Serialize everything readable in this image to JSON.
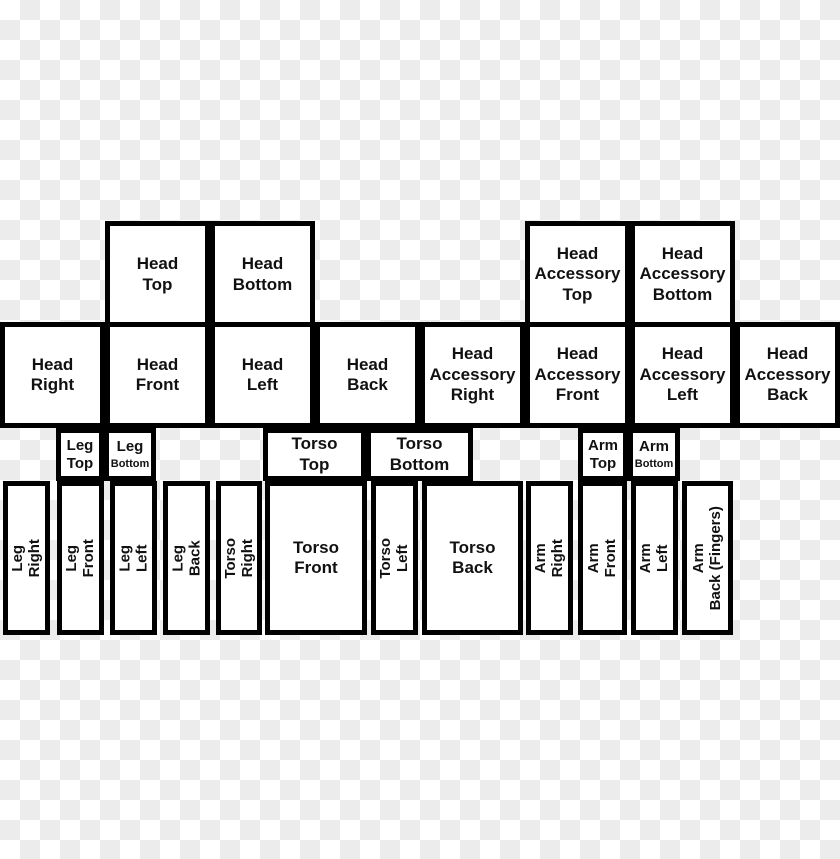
{
  "image": {
    "width": 840,
    "height": 859
  },
  "colors": {
    "checker_light": "#ffffff",
    "checker_dark": "#ececec",
    "box_fill": "#ffffff",
    "box_border": "#000000",
    "text": "#111111"
  },
  "cells": {
    "head_top": {
      "label": "Head\nTop"
    },
    "head_bottom": {
      "label": "Head\nBottom"
    },
    "head_accessory_top": {
      "label": "Head\nAccessory\nTop"
    },
    "head_accessory_bottom": {
      "label": "Head\nAccessory\nBottom"
    },
    "head_right": {
      "label": "Head\nRight"
    },
    "head_front": {
      "label": "Head\nFront"
    },
    "head_left": {
      "label": "Head\nLeft"
    },
    "head_back": {
      "label": "Head\nBack"
    },
    "head_accessory_right": {
      "label": "Head\nAccessory\nRight"
    },
    "head_accessory_front": {
      "label": "Head\nAccessory\nFront"
    },
    "head_accessory_left": {
      "label": "Head\nAccessory\nLeft"
    },
    "head_accessory_back": {
      "label": "Head\nAccessory\nBack"
    },
    "leg_top": {
      "label": "Leg\nTop"
    },
    "leg_bottom": {
      "label": "Leg\nBottom"
    },
    "torso_top": {
      "label": "Torso\nTop"
    },
    "torso_bottom": {
      "label": "Torso\nBottom"
    },
    "arm_top": {
      "label": "Arm\nTop"
    },
    "arm_bottom": {
      "label": "Arm\nBottom"
    },
    "leg_right": {
      "label": "Leg\nRight"
    },
    "leg_front": {
      "label": "Leg\nFront"
    },
    "leg_left": {
      "label": "Leg\nLeft"
    },
    "leg_back": {
      "label": "Leg\nBack"
    },
    "torso_right": {
      "label": "Torso\nRight"
    },
    "torso_front": {
      "label": "Torso\nFront"
    },
    "torso_left": {
      "label": "Torso\nLeft"
    },
    "torso_back": {
      "label": "Torso\nBack"
    },
    "arm_right": {
      "label": "Arm\nRight"
    },
    "arm_front": {
      "label": "Arm\nFront"
    },
    "arm_left": {
      "label": "Arm\nLeft"
    },
    "arm_back_fingers": {
      "label": "Arm\nBack (Fingers)"
    }
  }
}
